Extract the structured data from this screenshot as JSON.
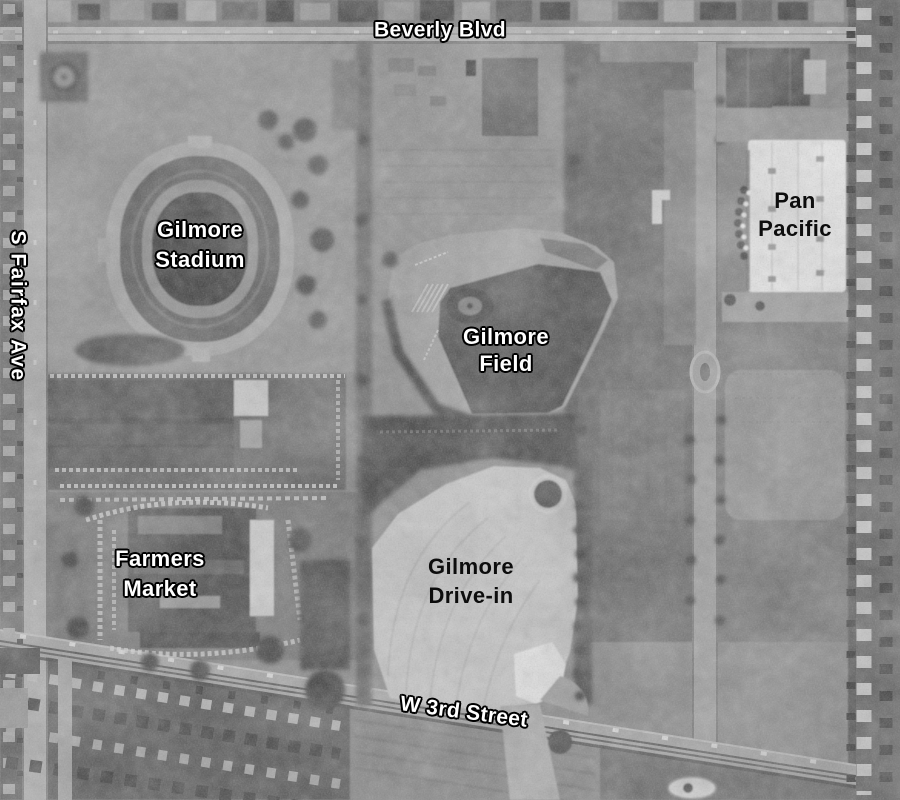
{
  "labels": {
    "beverly_blvd": {
      "text": "Beverly Blvd"
    },
    "s_fairfax_ave": {
      "text": "S Fairfax Ave"
    },
    "gilmore_stadium": {
      "line1": "Gilmore",
      "line2": "Stadium"
    },
    "gilmore_field": {
      "line1": "Gilmore",
      "line2": "Field"
    },
    "pan_pacific": {
      "line1": "Pan",
      "line2": "Pacific"
    },
    "farmers_market": {
      "line1": "Farmers",
      "line2": "Market"
    },
    "gilmore_drive_in": {
      "line1": "Gilmore",
      "line2": "Drive-in"
    },
    "w_3rd_street": {
      "text": "W 3rd Street"
    }
  },
  "colors": {
    "label_light": "#ffffff",
    "label_dark": "#0d0d0d",
    "label_outline": "#000000",
    "photo_base_gray": "#808080"
  }
}
